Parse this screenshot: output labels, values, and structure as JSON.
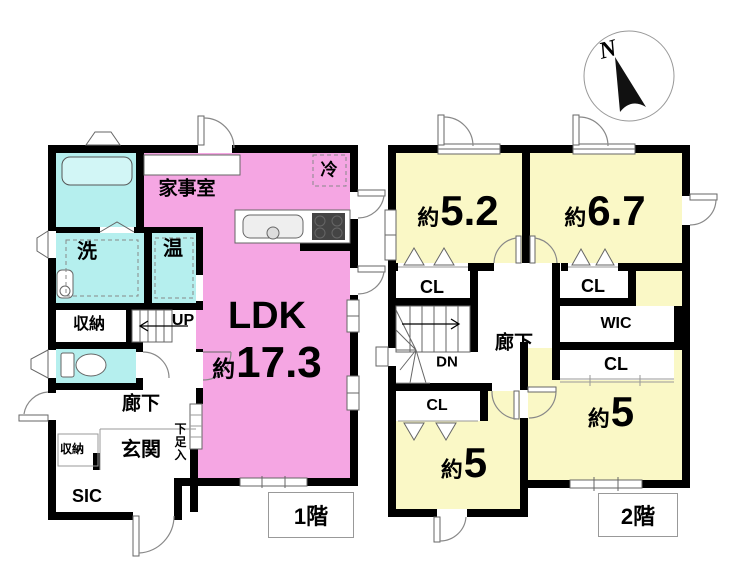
{
  "compass": {
    "north_label": "N"
  },
  "floor1": {
    "tag": "1階",
    "ldk_name": "LDK",
    "ldk_approx": "約",
    "ldk_area": "17.3",
    "kajishitsu": "家事室",
    "refrigerator": "冷",
    "laundry": "洗",
    "water_heater": "温",
    "storage_upper": "収納",
    "stairs_up": "UP",
    "hallway": "廊下",
    "entrance": "玄関",
    "shoe_cabinet": "下足入",
    "storage_lower": "収納",
    "sic": "SIC"
  },
  "floor2": {
    "tag": "2階",
    "room1_approx": "約",
    "room1_area": "5.2",
    "room2_approx": "約",
    "room2_area": "6.7",
    "room3_approx": "約",
    "room3_area": "5",
    "room4_approx": "約",
    "room4_area": "5",
    "closet1": "CL",
    "closet2": "CL",
    "closet3": "CL",
    "closet4": "CL",
    "wic": "WIC",
    "hallway": "廊下",
    "stairs_down": "DN"
  },
  "colors": {
    "ldk_pink": "#f5a6e3",
    "wet_area_cyan": "#b5efee",
    "tub_cyan": "#d2f6f6",
    "bedroom_yellow": "#faf8c6",
    "wall_black": "#000000"
  }
}
